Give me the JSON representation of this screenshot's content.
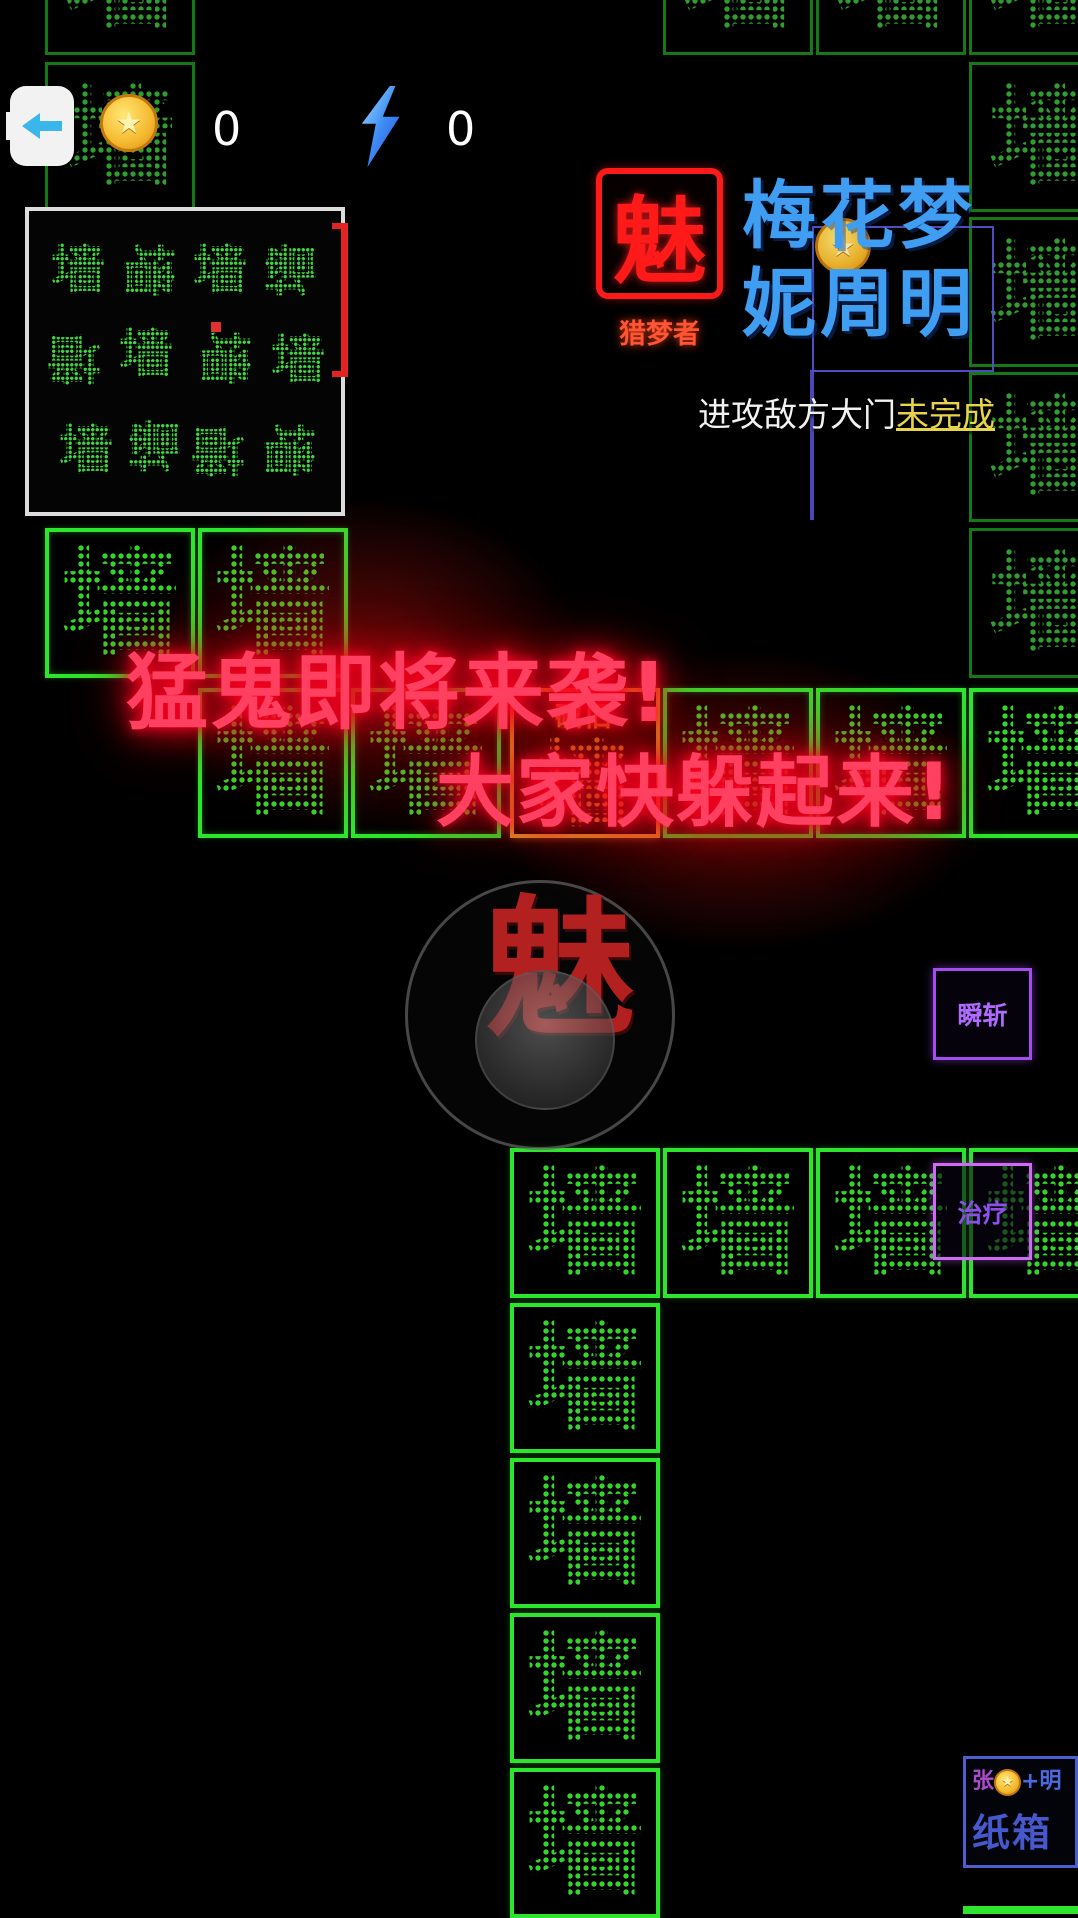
{
  "hud": {
    "coin_count": "0",
    "energy_count": "0"
  },
  "banner": {
    "logo_char": "魅",
    "logo_label": "猎梦者",
    "name_line1": "梅花梦",
    "name_line2": "妮周明",
    "objective_text": "进攻敌方大门",
    "objective_status": "未完成"
  },
  "warning": {
    "line1": "猛鬼即将来袭!",
    "line2": "大家快躲起来!"
  },
  "joystick": {
    "avatar_char": "魅"
  },
  "skills": [
    {
      "label": "瞬斩"
    },
    {
      "label": "治疗"
    }
  ],
  "box_entity": {
    "owner_prefix": "张",
    "owner_suffix": "+明",
    "label": "纸箱"
  },
  "tiles": {
    "glyph": "墙",
    "worn_label": "破旧",
    "list": [
      {
        "x": 45,
        "y": -95,
        "v": "dim"
      },
      {
        "x": 45,
        "y": 62,
        "v": "dim"
      },
      {
        "x": 663,
        "y": -95,
        "v": "dim"
      },
      {
        "x": 816,
        "y": -95,
        "v": "dim"
      },
      {
        "x": 969,
        "y": -95,
        "v": "dim"
      },
      {
        "x": 969,
        "y": 62,
        "v": "dim"
      },
      {
        "x": 969,
        "y": 217,
        "v": "dim"
      },
      {
        "x": 969,
        "y": 372,
        "v": "dim"
      },
      {
        "x": 969,
        "y": 528,
        "v": "dim"
      },
      {
        "x": 45,
        "y": 528,
        "v": "bright"
      },
      {
        "x": 198,
        "y": 528,
        "v": "bright"
      },
      {
        "x": 198,
        "y": 688,
        "v": "bright"
      },
      {
        "x": 351,
        "y": 688,
        "v": "bright"
      },
      {
        "x": 510,
        "y": 688,
        "v": "orange"
      },
      {
        "x": 663,
        "y": 688,
        "v": "bright"
      },
      {
        "x": 816,
        "y": 688,
        "v": "bright"
      },
      {
        "x": 969,
        "y": 688,
        "v": "bright"
      },
      {
        "x": 510,
        "y": 1148,
        "v": "wall"
      },
      {
        "x": 663,
        "y": 1148,
        "v": "wall"
      },
      {
        "x": 816,
        "y": 1148,
        "v": "wall"
      },
      {
        "x": 969,
        "y": 1148,
        "v": "wall"
      },
      {
        "x": 510,
        "y": 1303,
        "v": "wall"
      },
      {
        "x": 510,
        "y": 1458,
        "v": "wall"
      },
      {
        "x": 510,
        "y": 1613,
        "v": "wall"
      },
      {
        "x": 510,
        "y": 1768,
        "v": "wall"
      }
    ]
  },
  "minimap": {
    "glyph": "墙",
    "player_dot": {
      "x": 182,
      "y": 111
    },
    "clusters": [
      {
        "x": 22,
        "y": 32,
        "r": 0
      },
      {
        "x": 92,
        "y": 32,
        "r": 90
      },
      {
        "x": 164,
        "y": 32,
        "r": 0
      },
      {
        "x": 236,
        "y": 32,
        "r": 270
      },
      {
        "x": 18,
        "y": 120,
        "r": 180
      },
      {
        "x": 90,
        "y": 116,
        "r": 0
      },
      {
        "x": 168,
        "y": 120,
        "r": 90
      },
      {
        "x": 242,
        "y": 122,
        "r": 0
      },
      {
        "x": 30,
        "y": 212,
        "r": 0
      },
      {
        "x": 100,
        "y": 208,
        "r": 270
      },
      {
        "x": 162,
        "y": 212,
        "r": 180
      },
      {
        "x": 232,
        "y": 212,
        "r": 90
      }
    ]
  },
  "colors": {
    "wall_green": "#2ce52c",
    "dim_green": "#157a15",
    "warning_red": "#ff4060",
    "name_blue": "#3f9df2",
    "logo_red": "#ff1a1a",
    "skill_purple": "#a34df0",
    "status_yellow": "#e8d44a",
    "worn_orange": "#d89a28",
    "crate_blue": "#4a5fd0"
  }
}
